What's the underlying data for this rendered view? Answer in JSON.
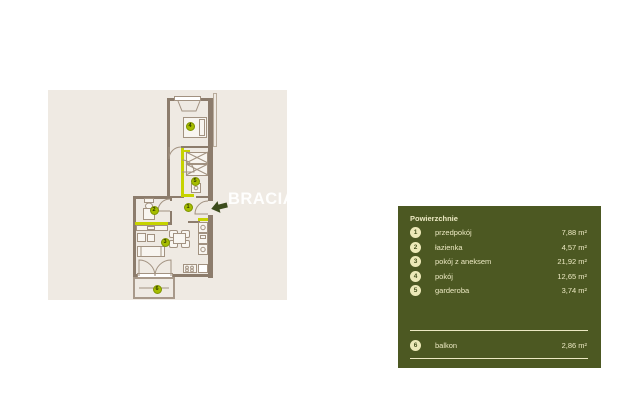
{
  "watermark": "BRACIA",
  "plan": {
    "markers": [
      "1",
      "2",
      "3",
      "4",
      "5",
      "6"
    ]
  },
  "legend": {
    "title": "Powierzchnie",
    "rooms": [
      {
        "num": "1",
        "label": "przedpokój",
        "area": "7,88 m²"
      },
      {
        "num": "2",
        "label": "łazienka",
        "area": "4,57 m²"
      },
      {
        "num": "3",
        "label": "pokój z aneksem",
        "area": "21,92 m²"
      },
      {
        "num": "4",
        "label": "pokój",
        "area": "12,65 m²"
      },
      {
        "num": "5",
        "label": "garderoba",
        "area": "3,74 m²"
      }
    ],
    "extra": [
      {
        "num": "6",
        "label": "balkon",
        "area": "2,86 m²"
      }
    ]
  },
  "colors": {
    "panel_bg": "#4c5822",
    "panel_text": "#ece9c3",
    "badge_bg": "#ece9b8",
    "plan_bg": "#efeae3",
    "wall": "#8c7c6c",
    "accent_lime": "#c6d300",
    "marker_bg": "#a6bd00",
    "arrow_green": "#3c4c1c"
  }
}
